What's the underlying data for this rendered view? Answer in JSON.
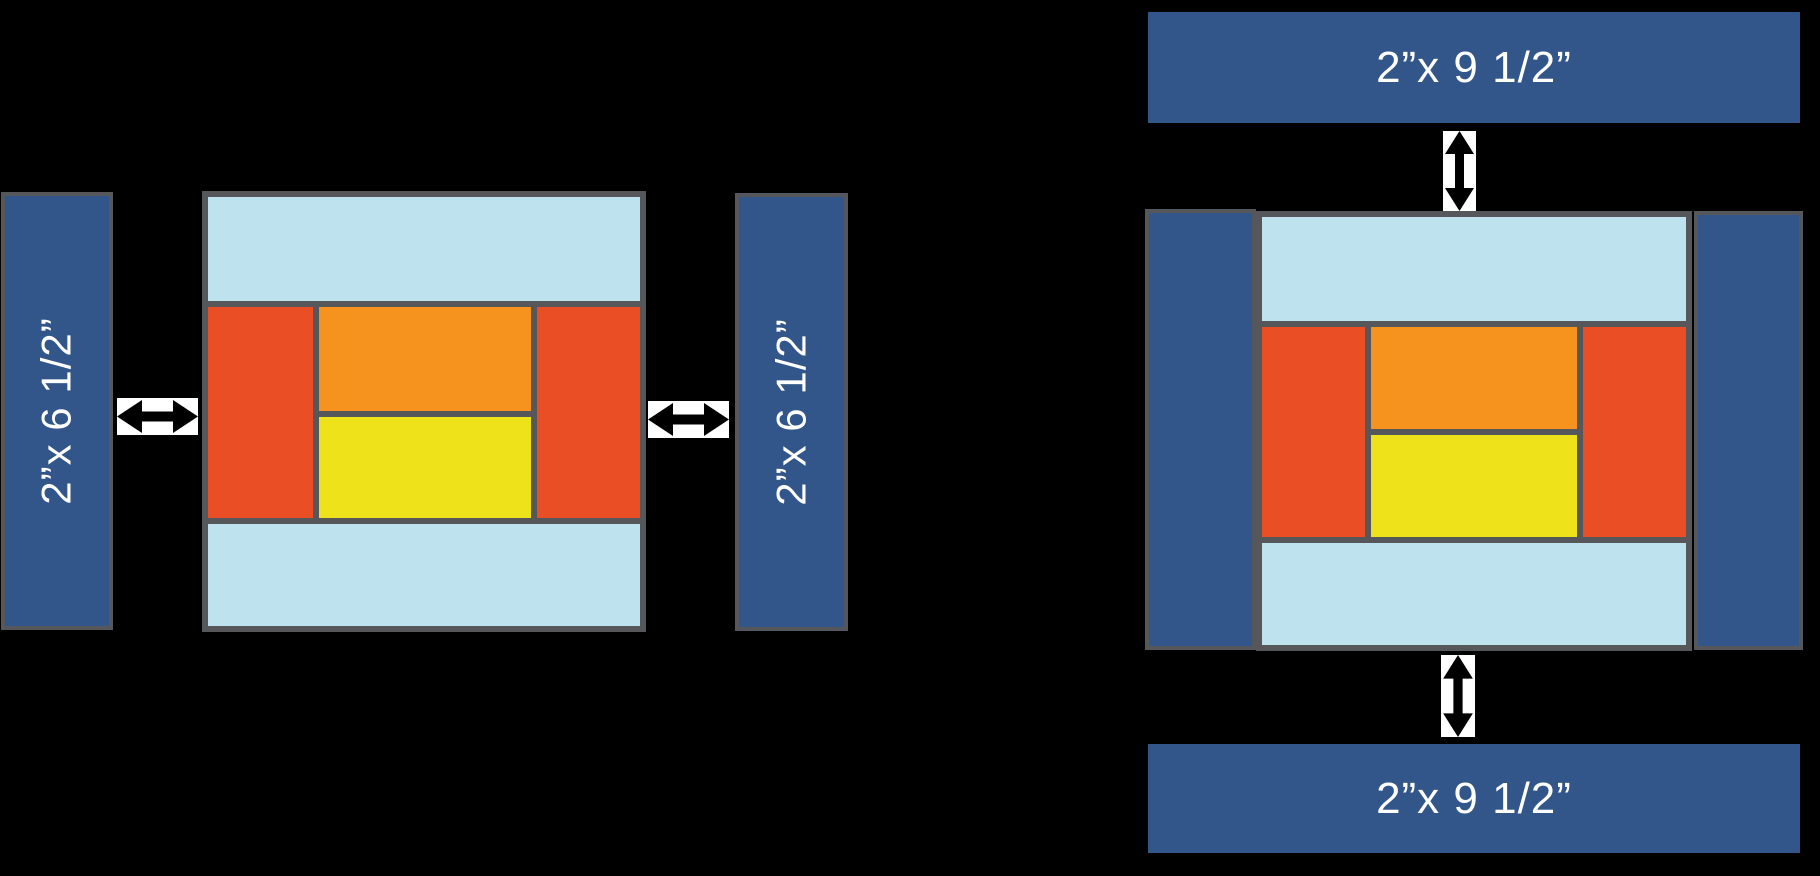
{
  "background": "#000000",
  "palette": {
    "navy_strip": "#32568A",
    "light_blue": "#BFE2EF",
    "red_orange": "#E94E24",
    "orange": "#F6921E",
    "yellow": "#EEE31A",
    "border_gray": "#56575A",
    "arrow_box": "#FFFFFF",
    "arrow_color": "#000000",
    "label_color": "#FFFFFF"
  },
  "step1": {
    "left_strip_label": "2”x 6 1/2”",
    "right_strip_label": "2”x 6 1/2”"
  },
  "step2": {
    "top_bar_label": "2”x 9 1/2”",
    "bottom_bar_label": "2”x 9 1/2”"
  },
  "icons": {
    "horizontal_double_arrow": "↔",
    "vertical_double_arrow": "↕"
  }
}
